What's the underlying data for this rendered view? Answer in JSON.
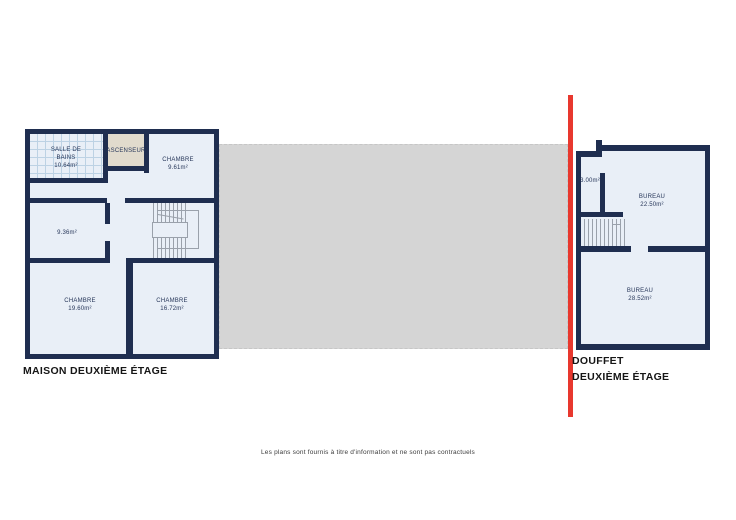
{
  "left_plan": {
    "title": "MAISON DEUXIÈME ÉTAGE",
    "rooms": [
      {
        "name": "SALLE DE BAINS",
        "area": "10.64m²"
      },
      {
        "name": "ASCENSEUR",
        "area": ""
      },
      {
        "name": "CHAMBRE",
        "area": "9.61m²"
      },
      {
        "name": "",
        "area": "9.36m²"
      },
      {
        "name": "CHAMBRE",
        "area": "19.60m²"
      },
      {
        "name": "CHAMBRE",
        "area": "16.72m²"
      }
    ]
  },
  "right_plan": {
    "title_line1": "DOUFFET",
    "title_line2": "DEUXIÈME ÉTAGE",
    "rooms": [
      {
        "name": "",
        "area": "3.00m²"
      },
      {
        "name": "BUREAU",
        "area": "22.50m²"
      },
      {
        "name": "BUREAU",
        "area": "28.52m²"
      }
    ]
  },
  "footer": {
    "disclaimer": "Les plans sont fournis à titre d'information et ne sont pas contractuels"
  },
  "colors": {
    "wall": "#1f2e50",
    "room_fill": "#e9eff7",
    "tile": "#bdd2e4",
    "elevator": "#e1dbcd",
    "tread": "#9aa1ab",
    "zone": "#d5d5d5",
    "zone_border": "#c6c6c6",
    "red": "#e8382e",
    "title_text": "#161616",
    "room_text": "#263659",
    "footer_text": "#3c3c3c"
  }
}
